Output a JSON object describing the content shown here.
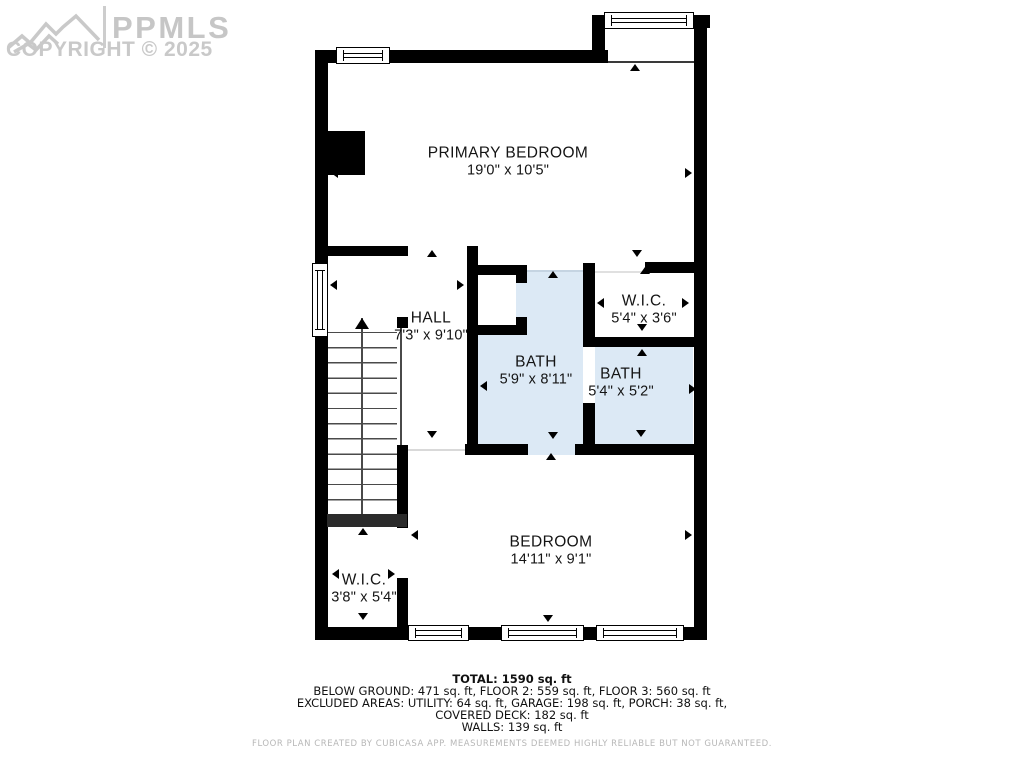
{
  "logo": {
    "brand": "PPMLS",
    "copyright": "COPYRIGHT © 2025",
    "mountain_icon": "mountain-logo-icon"
  },
  "rooms": [
    {
      "name": "PRIMARY BEDROOM",
      "dims": "19'0\" x 10'5\""
    },
    {
      "name": "HALL",
      "dims": "7'3\" x 9'10\""
    },
    {
      "name": "W.I.C.",
      "dims": "5'4\" x 3'6\""
    },
    {
      "name": "BATH",
      "dims": "5'9\" x 8'11\""
    },
    {
      "name": "BATH",
      "dims": "5'4\" x 5'2\""
    },
    {
      "name": "BEDROOM",
      "dims": "14'11\" x 9'1\""
    },
    {
      "name": "W.I.C.",
      "dims": "3'8\" x 5'4\""
    }
  ],
  "summary": {
    "total": "TOTAL: 1590 sq. ft",
    "line1": "BELOW GROUND: 471 sq. ft, FLOOR 2: 559 sq. ft, FLOOR 3: 560 sq. ft",
    "line2": "EXCLUDED AREAS: UTILITY: 64 sq. ft, GARAGE: 198 sq. ft, PORCH: 38 sq. ft,",
    "line3": "COVERED DECK: 182 sq. ft",
    "line4": "WALLS: 139 sq. ft"
  },
  "disclaimer": "FLOOR PLAN CREATED BY CUBICASA APP. MEASUREMENTS DEEMED HIGHLY RELIABLE BUT NOT GUARANTEED.",
  "colors": {
    "wall": "#000000",
    "bath_fill": "#dce9f5",
    "logo_gray": "#c6c6c6",
    "disclaimer_gray": "#b7b7b7"
  },
  "stairs": {
    "direction": "up"
  },
  "markers": [
    {
      "x": 635,
      "y": 64,
      "d": "up"
    },
    {
      "x": 331,
      "y": 173,
      "d": "left"
    },
    {
      "x": 692,
      "y": 173,
      "d": "right"
    },
    {
      "x": 432,
      "y": 250,
      "d": "up"
    },
    {
      "x": 330,
      "y": 285,
      "d": "left"
    },
    {
      "x": 464,
      "y": 285,
      "d": "right"
    },
    {
      "x": 553,
      "y": 271,
      "d": "up"
    },
    {
      "x": 637,
      "y": 257,
      "d": "down"
    },
    {
      "x": 645,
      "y": 267,
      "d": "up"
    },
    {
      "x": 597,
      "y": 303,
      "d": "left"
    },
    {
      "x": 689,
      "y": 303,
      "d": "right"
    },
    {
      "x": 642,
      "y": 331,
      "d": "down"
    },
    {
      "x": 642,
      "y": 349,
      "d": "up"
    },
    {
      "x": 480,
      "y": 386,
      "d": "left"
    },
    {
      "x": 696,
      "y": 389,
      "d": "right"
    },
    {
      "x": 432,
      "y": 438,
      "d": "down"
    },
    {
      "x": 553,
      "y": 439,
      "d": "down"
    },
    {
      "x": 641,
      "y": 437,
      "d": "down"
    },
    {
      "x": 551,
      "y": 453,
      "d": "up"
    },
    {
      "x": 411,
      "y": 535,
      "d": "left"
    },
    {
      "x": 692,
      "y": 535,
      "d": "right"
    },
    {
      "x": 363,
      "y": 528,
      "d": "up"
    },
    {
      "x": 332,
      "y": 574,
      "d": "left"
    },
    {
      "x": 395,
      "y": 574,
      "d": "right"
    },
    {
      "x": 548,
      "y": 622,
      "d": "down"
    },
    {
      "x": 363,
      "y": 620,
      "d": "down"
    }
  ]
}
